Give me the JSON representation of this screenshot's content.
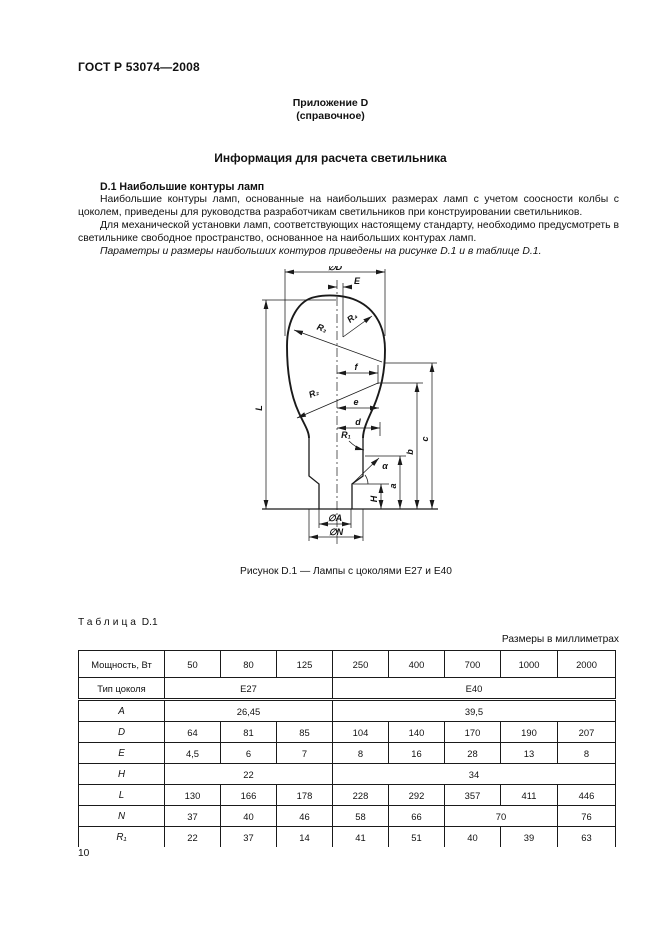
{
  "header": {
    "standard": "ГОСТ Р 53074—2008",
    "annex_line1": "Приложение D",
    "annex_line2": "(справочное)"
  },
  "title": "Информация для расчета светильника",
  "section": {
    "heading": "D.1  Наибольшие контуры ламп",
    "para1": "Наибольшие контуры ламп, основанные на наибольших размерах ламп с учетом соосности колбы с цоколем, приведены для руководства разработчикам светильников при конструировании светильников.",
    "para2": "Для механической установки ламп, соответствующих настоящему стандарту, необходимо предусмотреть в светильнике свободное пространство, основанное на наибольших контурах ламп.",
    "para3": "Параметры и размеры наибольших контуров приведены на рисунке D.1 и в таблице D.1."
  },
  "figure": {
    "caption": "Рисунок D.1 — Лампы с цоколями Е27 и Е40",
    "labels": {
      "dia_D": "∅D",
      "E": "E",
      "R4": "R₄",
      "R3": "R₃",
      "f": "f",
      "R2": "R₂",
      "e": "е",
      "d": "d",
      "R1": "R₁",
      "alpha": "α",
      "H": "H",
      "a": "a",
      "b": "b",
      "c": "c",
      "L": "L",
      "dia_A": "∅A",
      "dia_N": "∅N"
    }
  },
  "table": {
    "title_word": "Таблица",
    "title_num": "D.1",
    "units_note": "Размеры в миллиметрах",
    "rows": [
      {
        "label": "Мощность, Вт",
        "italic": false,
        "cells": [
          {
            "t": "50",
            "s": 1
          },
          {
            "t": "80",
            "s": 1
          },
          {
            "t": "125",
            "s": 1
          },
          {
            "t": "250",
            "s": 1
          },
          {
            "t": "400",
            "s": 1
          },
          {
            "t": "700",
            "s": 1
          },
          {
            "t": "1000",
            "s": 1
          },
          {
            "t": "2000",
            "s": 1
          }
        ]
      },
      {
        "label": "Тип цоколя",
        "italic": false,
        "cells": [
          {
            "t": "Е27",
            "s": 3
          },
          {
            "t": "Е40",
            "s": 5
          }
        ]
      },
      {
        "label": "A",
        "italic": true,
        "cells": [
          {
            "t": "26,45",
            "s": 3
          },
          {
            "t": "39,5",
            "s": 5
          }
        ]
      },
      {
        "label": "D",
        "italic": true,
        "cells": [
          {
            "t": "64",
            "s": 1
          },
          {
            "t": "81",
            "s": 1
          },
          {
            "t": "85",
            "s": 1
          },
          {
            "t": "104",
            "s": 1
          },
          {
            "t": "140",
            "s": 1
          },
          {
            "t": "170",
            "s": 1
          },
          {
            "t": "190",
            "s": 1
          },
          {
            "t": "207",
            "s": 1
          }
        ]
      },
      {
        "label": "E",
        "italic": true,
        "cells": [
          {
            "t": "4,5",
            "s": 1
          },
          {
            "t": "6",
            "s": 1
          },
          {
            "t": "7",
            "s": 1
          },
          {
            "t": "8",
            "s": 1
          },
          {
            "t": "16",
            "s": 1
          },
          {
            "t": "28",
            "s": 1
          },
          {
            "t": "13",
            "s": 1
          },
          {
            "t": "8",
            "s": 1
          }
        ]
      },
      {
        "label": "H",
        "italic": true,
        "cells": [
          {
            "t": "22",
            "s": 3
          },
          {
            "t": "34",
            "s": 5
          }
        ]
      },
      {
        "label": "L",
        "italic": true,
        "cells": [
          {
            "t": "130",
            "s": 1
          },
          {
            "t": "166",
            "s": 1
          },
          {
            "t": "178",
            "s": 1
          },
          {
            "t": "228",
            "s": 1
          },
          {
            "t": "292",
            "s": 1
          },
          {
            "t": "357",
            "s": 1
          },
          {
            "t": "411",
            "s": 1
          },
          {
            "t": "446",
            "s": 1
          }
        ]
      },
      {
        "label": "N",
        "italic": true,
        "cells": [
          {
            "t": "37",
            "s": 1
          },
          {
            "t": "40",
            "s": 1
          },
          {
            "t": "46",
            "s": 1
          },
          {
            "t": "58",
            "s": 1
          },
          {
            "t": "66",
            "s": 1
          },
          {
            "t": "70",
            "s": 2
          },
          {
            "t": "76",
            "s": 1
          }
        ]
      },
      {
        "label": "R₁",
        "italic": true,
        "cells": [
          {
            "t": "22",
            "s": 1
          },
          {
            "t": "37",
            "s": 1
          },
          {
            "t": "14",
            "s": 1
          },
          {
            "t": "41",
            "s": 1
          },
          {
            "t": "51",
            "s": 1
          },
          {
            "t": "40",
            "s": 1
          },
          {
            "t": "39",
            "s": 1
          },
          {
            "t": "63",
            "s": 1
          }
        ]
      }
    ]
  },
  "page": {
    "number": "10"
  }
}
